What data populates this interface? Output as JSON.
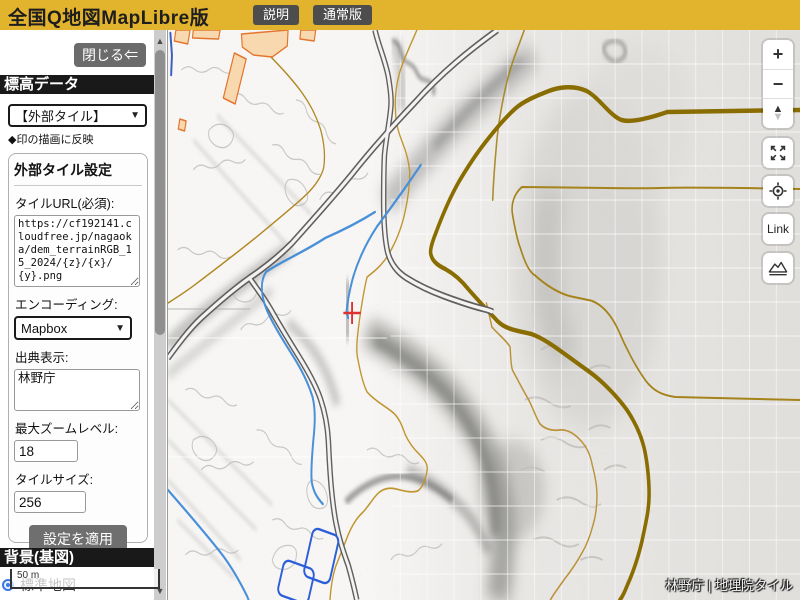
{
  "topbar": {
    "title": "全国Q地図MapLibre版",
    "buttons": [
      {
        "label": "説明"
      },
      {
        "label": "通常版"
      }
    ]
  },
  "sidebar": {
    "close_button": "閉じる⇐",
    "elevation_header": "標高データ",
    "elevation_select_value": "【外部タイル】",
    "elevation_note": "◆印の描画に反映",
    "tile_settings": {
      "title": "外部タイル設定",
      "url_label": "タイルURL(必須):",
      "url_value": "https://cf192141.cloudfree.jp/nagaoka/dem_terrainRGB_15_2024/{z}/{x}/{y}.png",
      "encoding_label": "エンコーディング:",
      "encoding_value": "Mapbox",
      "attribution_label": "出典表示:",
      "attribution_value": "林野庁",
      "max_zoom_label": "最大ズームレベル:",
      "max_zoom_value": "18",
      "tile_size_label": "タイルサイズ:",
      "tile_size_value": "256",
      "apply_button": "設定を適用"
    },
    "background_header": "背景(基図)",
    "background_options": [
      {
        "label": "標準地図",
        "selected": true
      }
    ]
  },
  "map": {
    "scale_label": "50 m",
    "attribution": "林野庁 | 地理院タイル",
    "controls": {
      "zoom_in": "+",
      "zoom_out": "−",
      "link": "Link"
    },
    "marker": {
      "x": 401,
      "y": 313,
      "color": "#e03131"
    }
  },
  "colors": {
    "topbar_yellow": "#e2b32c",
    "header_black": "#191919",
    "button_gray": "#6b6b6b",
    "contour_thick": "#8a6d00",
    "contour_thin": "#c0952e",
    "water_blue": "#4a90d9",
    "building_fill": "#f8d8ae",
    "building_stroke": "#e4752d",
    "marker_red": "#e03131"
  }
}
